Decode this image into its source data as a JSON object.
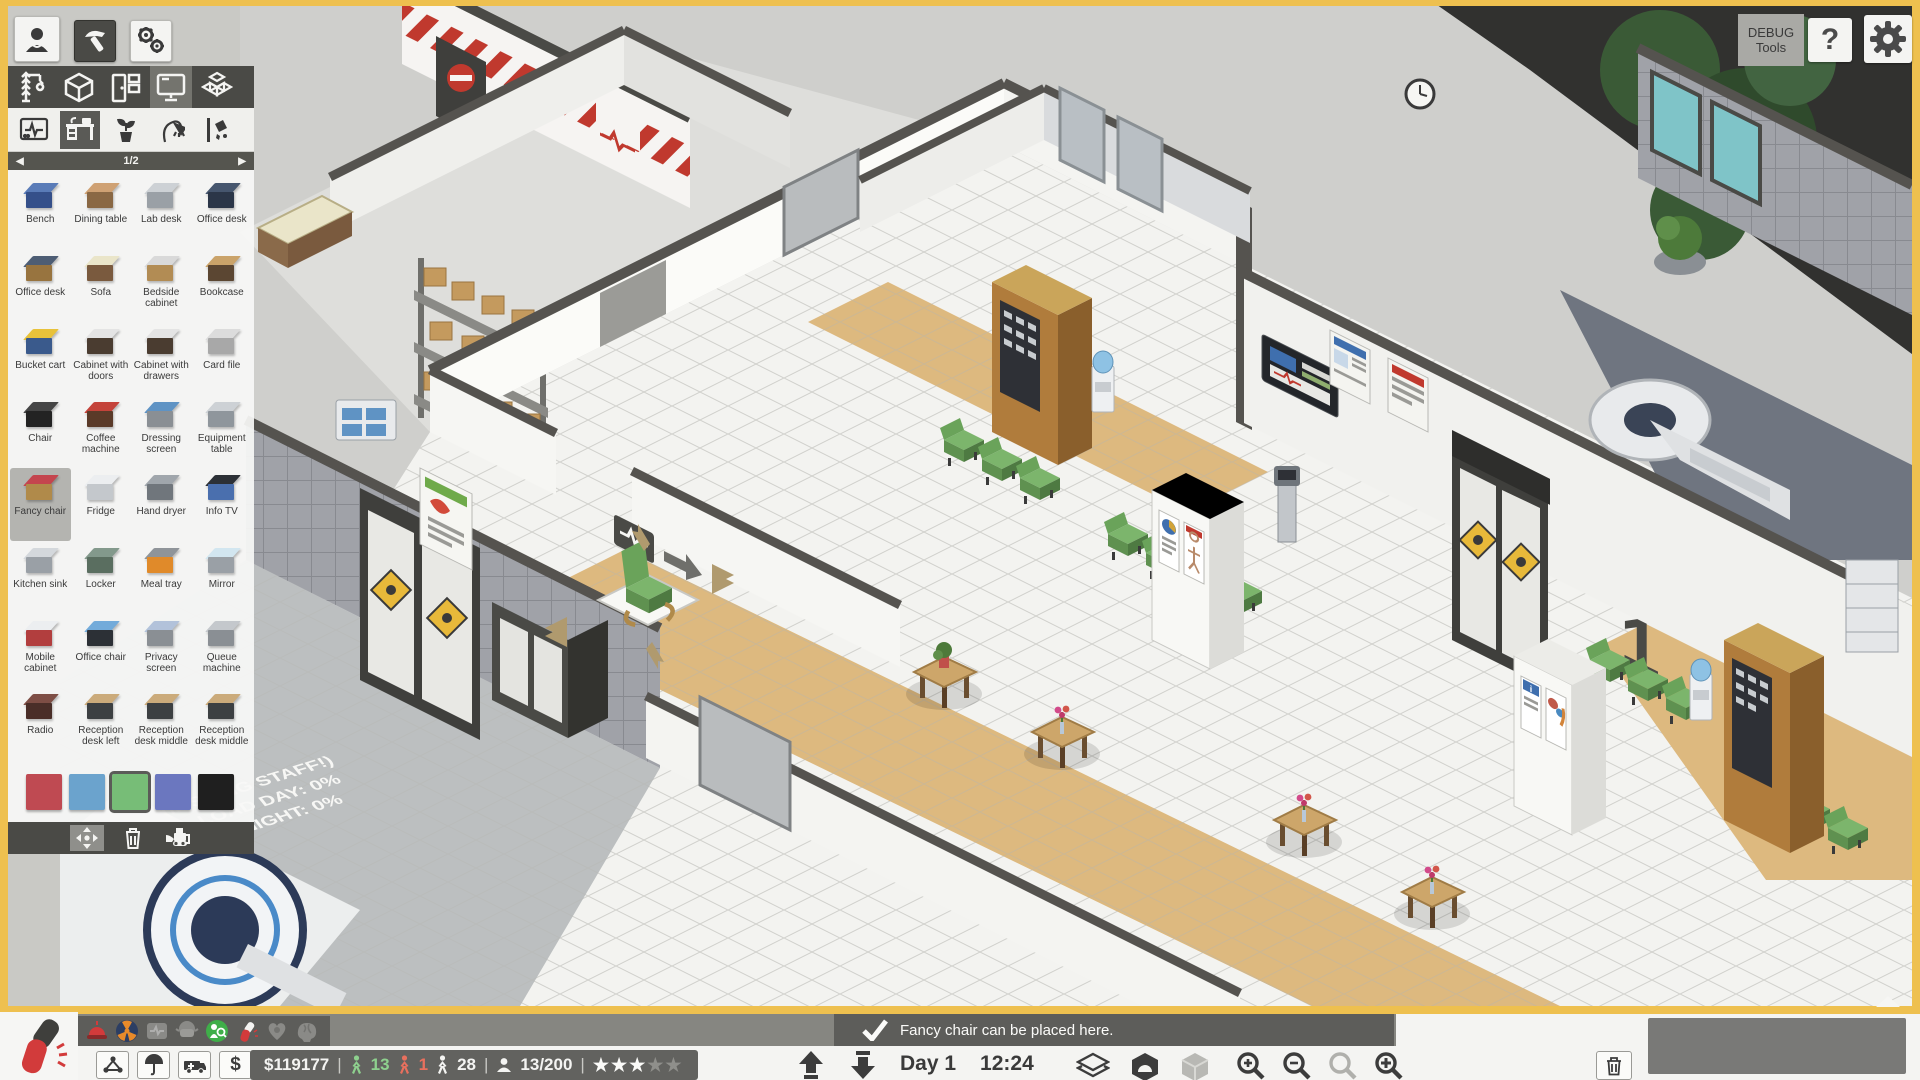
{
  "top_right": {
    "debug_line1": "DEBUG",
    "debug_line2": "Tools",
    "help": "?"
  },
  "build_panel": {
    "page": "1/2",
    "prev_arrow": "◀",
    "next_arrow": "▶",
    "items": [
      {
        "label": "Bench",
        "c1": "#5a7cb8",
        "c2": "#35508a"
      },
      {
        "label": "Dining table",
        "c1": "#cfa173",
        "c2": "#8a6844"
      },
      {
        "label": "Lab desk",
        "c1": "#cdd1d5",
        "c2": "#9aa0a6"
      },
      {
        "label": "Office desk",
        "c1": "#46566e",
        "c2": "#2b3648"
      },
      {
        "label": "Office desk",
        "c1": "#4d5d74",
        "c2": "#98743f"
      },
      {
        "label": "Sofa",
        "c1": "#eae5c9",
        "c2": "#7a5a3e"
      },
      {
        "label": "Bedside cabinet",
        "c1": "#d9d9d9",
        "c2": "#b28c54"
      },
      {
        "label": "Bookcase",
        "c1": "#caa36a",
        "c2": "#5b4632"
      },
      {
        "label": "Bucket cart",
        "c1": "#e8c23a",
        "c2": "#3a5a8c"
      },
      {
        "label": "Cabinet with doors",
        "c1": "#e4e4e4",
        "c2": "#4a3c30"
      },
      {
        "label": "Cabinet with drawers",
        "c1": "#e4e4e4",
        "c2": "#4a3c30"
      },
      {
        "label": "Card file",
        "c1": "#dcdcdc",
        "c2": "#a8a8a8"
      },
      {
        "label": "Chair",
        "c1": "#454545",
        "c2": "#232323"
      },
      {
        "label": "Coffee machine",
        "c1": "#c4433a",
        "c2": "#5a3a28"
      },
      {
        "label": "Dressing screen",
        "c1": "#5f93c4",
        "c2": "#8a8f94"
      },
      {
        "label": "Equipment table",
        "c1": "#cdd1d5",
        "c2": "#8f969c"
      },
      {
        "label": "Fancy chair",
        "c1": "#c4454e",
        "c2": "#b08a4a",
        "selected": true
      },
      {
        "label": "Fridge",
        "c1": "#eceef0",
        "c2": "#c4c8cc"
      },
      {
        "label": "Hand dryer",
        "c1": "#a0a6ac",
        "c2": "#70767c"
      },
      {
        "label": "Info TV",
        "c1": "#2c3036",
        "c2": "#4a6fae"
      },
      {
        "label": "Kitchen sink",
        "c1": "#d4d8dc",
        "c2": "#9aa0a6"
      },
      {
        "label": "Locker",
        "c1": "#83998c",
        "c2": "#5a6e60"
      },
      {
        "label": "Meal tray",
        "c1": "#8f9499",
        "c2": "#e08a2a"
      },
      {
        "label": "Mirror",
        "c1": "#d2e6f0",
        "c2": "#9aa0a6"
      },
      {
        "label": "Mobile cabinet",
        "c1": "#eceef0",
        "c2": "#b23e3e"
      },
      {
        "label": "Office chair",
        "c1": "#73abda",
        "c2": "#2c3036"
      },
      {
        "label": "Privacy screen",
        "c1": "#b2c2da",
        "c2": "#8a8f94"
      },
      {
        "label": "Queue machine",
        "c1": "#c4c8cc",
        "c2": "#8a8f94"
      },
      {
        "label": "Radio",
        "c1": "#7e4e45",
        "c2": "#4a2e28"
      },
      {
        "label": "Reception desk left",
        "c1": "#cbab7b",
        "c2": "#3c4042"
      },
      {
        "label": "Reception desk middle",
        "c1": "#cbab7b",
        "c2": "#3c4042"
      },
      {
        "label": "Reception desk middle",
        "c1": "#cbab7b",
        "c2": "#3c4042"
      }
    ],
    "colors": [
      "#bf4a52",
      "#6ba3cd",
      "#77bd77",
      "#6b77bf",
      "#1f1f1f"
    ],
    "selected_color_index": 2,
    "selected_item": "Fancy chair"
  },
  "notification": {
    "text": "Fancy chair can be placed here."
  },
  "hud": {
    "money": "$119177",
    "staff_ok": "13",
    "staff_warn": "1",
    "patients": "28",
    "capacity": "13/200",
    "stars_filled": 3,
    "stars_total": 5,
    "day": "Day 1",
    "time": "12:24",
    "dollar": "$"
  },
  "scene": {
    "room_number": "1",
    "floor_text_1": "(MISSING STAFF!)",
    "floor_text_2": "LOAD DAY: 0%",
    "floor_text_3": "NIGHT: 0%"
  }
}
